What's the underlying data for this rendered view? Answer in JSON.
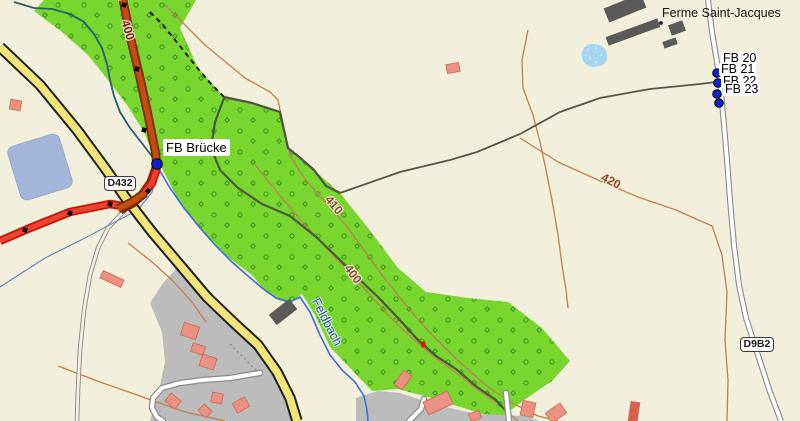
{
  "map": {
    "labels": {
      "farm": "Ferme Saint-Jacques",
      "bridge_waypoint": "FB Brücke",
      "waypoints": [
        {
          "label": "FB 20"
        },
        {
          "label": "FB 21"
        },
        {
          "label": "FB 22"
        },
        {
          "label": "FB 23"
        }
      ],
      "shield_d432": "D432",
      "shield_d9b2": "D9B2",
      "road_elevation": "400",
      "contour_upper": "410",
      "contour_lower": "400",
      "contour_east": "420",
      "stream": "Feldbach"
    },
    "colors": {
      "background": "#f2efdc",
      "forest_green": "#78d62e",
      "tree_symbol_green": "#3c941c",
      "road_yellow": "#f3e57a",
      "road_orange": "#c34c10",
      "track_red": "#ef4130",
      "waypoint_blue": "#1020cc",
      "water_stream": "#3f6bd6",
      "pond_gray_blue": "#a3b5d8",
      "pond_light_blue": "#a5d5f0",
      "building_salmon": "#ea9181",
      "building_dark_gray": "#5a5a5a",
      "residential_gray": "#bcbcbc",
      "contour_brown": "#c08050"
    }
  }
}
